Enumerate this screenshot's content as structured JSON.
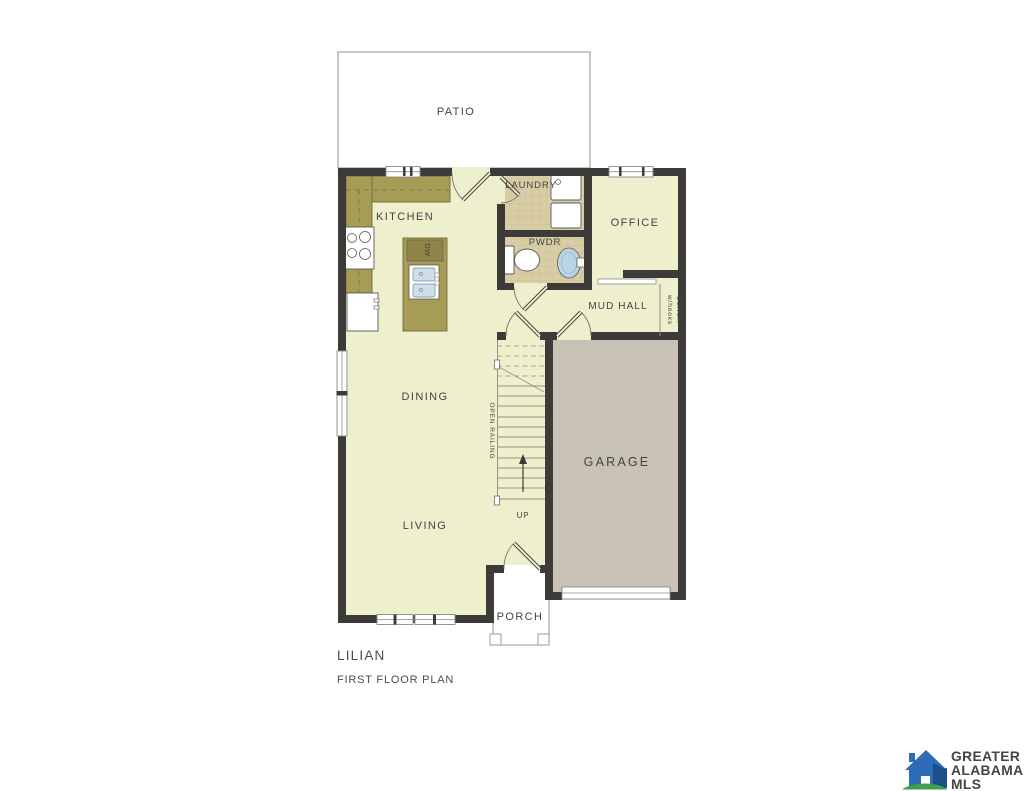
{
  "plan": {
    "title": "LILIAN",
    "subtitle": "FIRST FLOOR PLAN",
    "rooms": {
      "patio": "PATIO",
      "kitchen": "KITCHEN",
      "laundry": "LAUNDRY",
      "office": "OFFICE",
      "pwdr": "PWDR",
      "mud_hall": "MUD HALL",
      "dining": "DINING",
      "living": "LIVING",
      "garage": "GARAGE",
      "porch": "PORCH"
    },
    "labels": {
      "open_railing": "OPEN RAILING",
      "bench": "BENCH",
      "bench_sub": "w/hooks",
      "up": "UP",
      "dishwasher": "DW"
    },
    "colors": {
      "floor": "#eef0cd",
      "counter": "#a79c55",
      "counter_dark": "#8f8549",
      "tile": "#d9cda6",
      "garage": "#c8c1b5",
      "wall": "#3c3b37"
    }
  },
  "logo": {
    "line1": "GREATER",
    "line2": "ALABAMA",
    "line3": "MLS",
    "colors": {
      "house_blue": "#2e6cb5",
      "house_dark_blue": "#1d4e87",
      "green": "#3da04a",
      "teal_text": "#2089ae",
      "blue_text": "#1b639a"
    }
  }
}
